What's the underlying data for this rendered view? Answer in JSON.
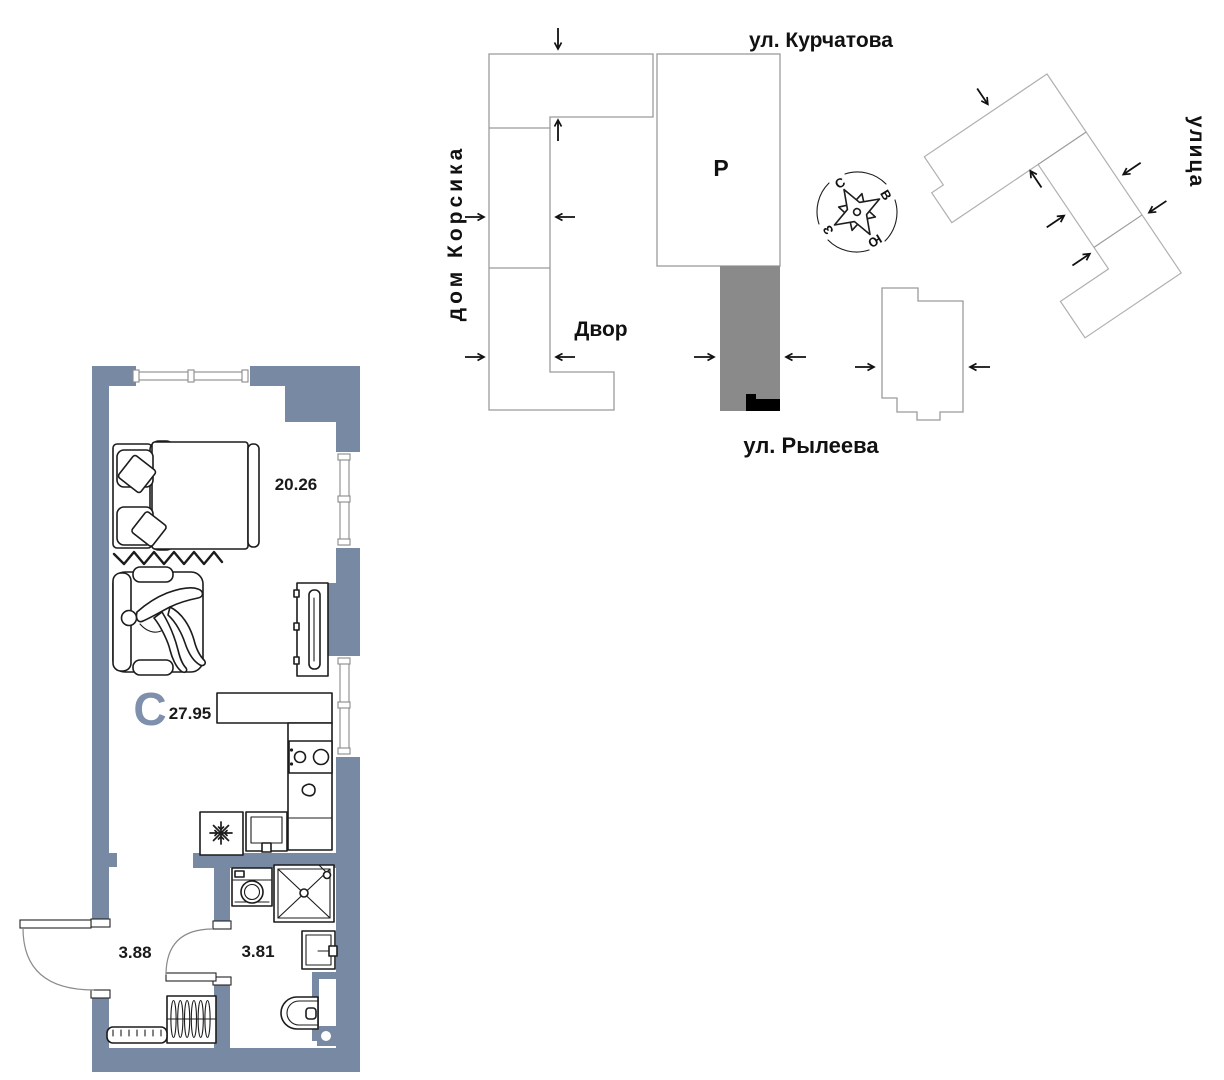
{
  "site_plan": {
    "street_top": "ул. Курчатова",
    "street_bottom": "ул. Рылеева",
    "house_left": "дом Корсика",
    "street_right": "улица",
    "courtyard": "Двор",
    "parking": "Р",
    "compass": {
      "north": "С",
      "east": "В",
      "south": "Ю",
      "west": "З"
    },
    "colors": {
      "building_outline": "#9b9b9b",
      "highlight_fill": "#8a8a8a",
      "entrance_mark": "#000000"
    }
  },
  "floor_plan": {
    "type_letter": "С",
    "total_area": "27.95",
    "living_area": "20.26",
    "hall_area": "3.88",
    "bath_area": "3.81",
    "colors": {
      "wall": "#7789a3",
      "type_letter": "#7e90ac",
      "line": "#1c1c1c"
    },
    "furniture": [
      "bed",
      "pillows",
      "sofa",
      "person",
      "tv-stand",
      "kitchen-counter",
      "stove",
      "kitchen-sink",
      "fridge",
      "sink-cabinet",
      "washing-machine",
      "shower",
      "bathroom-sink",
      "toilet",
      "wardrobe",
      "bench"
    ]
  }
}
